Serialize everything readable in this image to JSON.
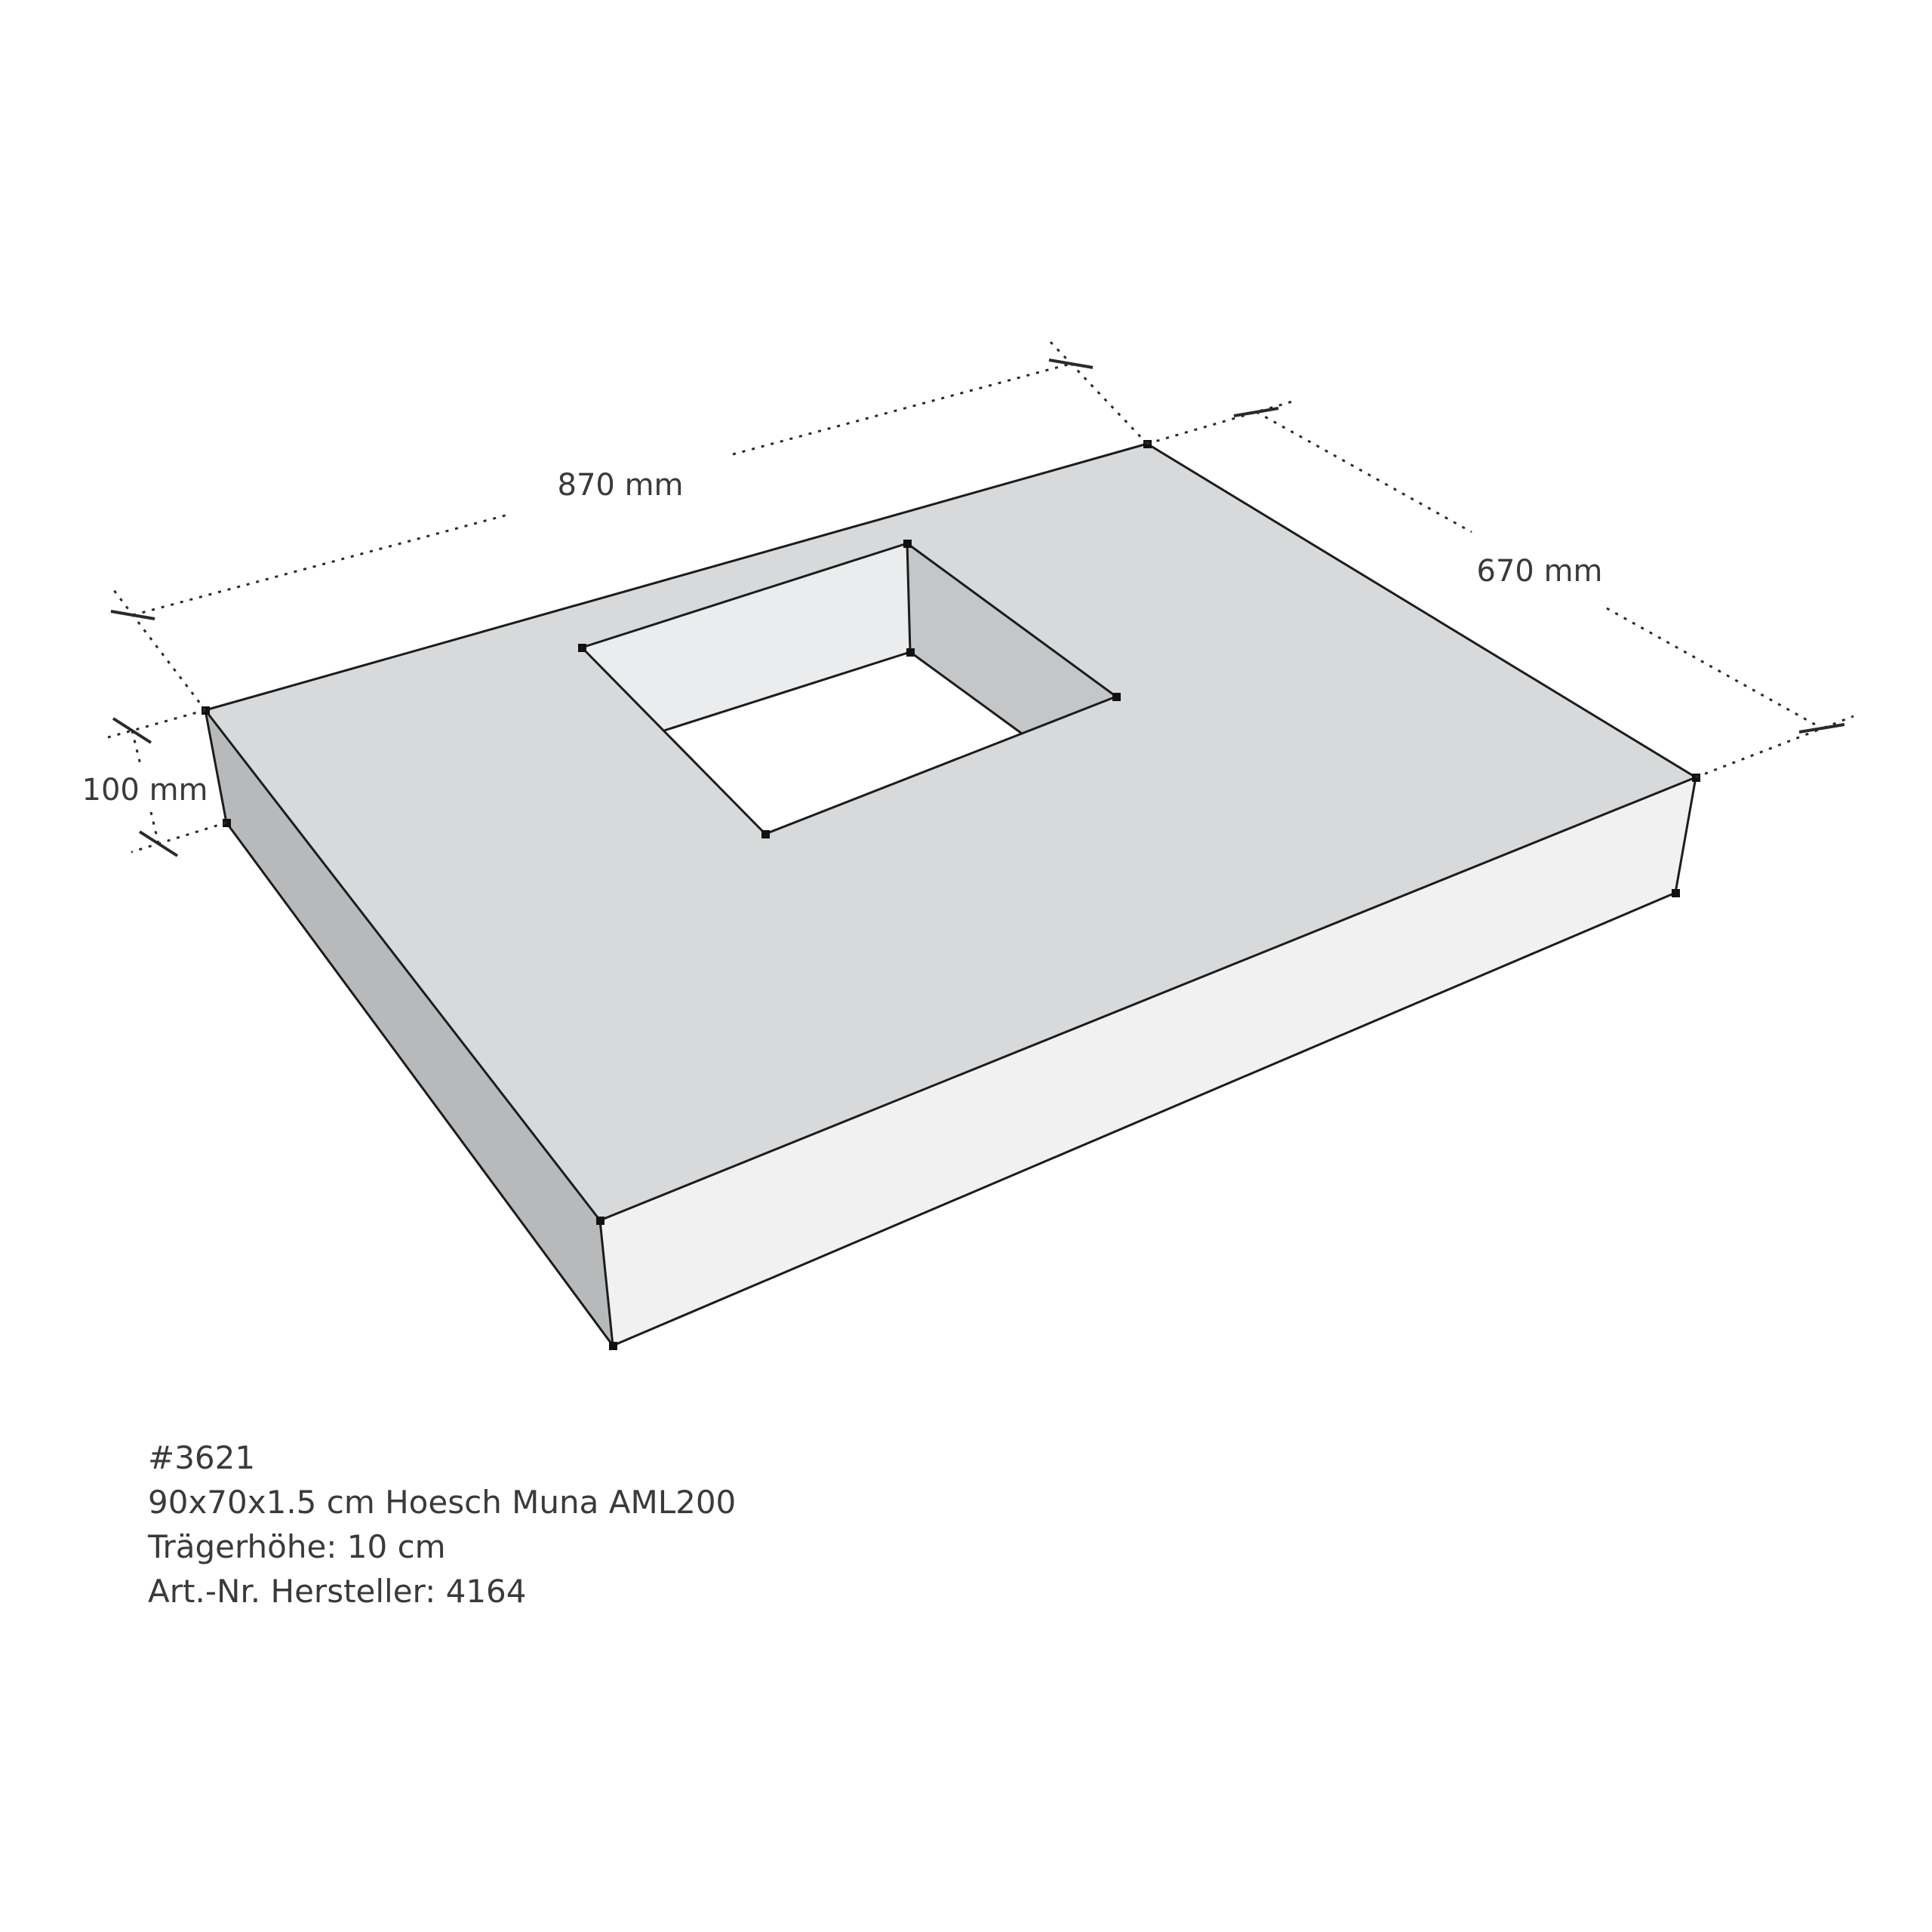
{
  "dimensions": {
    "width_label": "870 mm",
    "depth_label": "670 mm",
    "height_label": "100 mm"
  },
  "product_info": {
    "id": "#3621",
    "name": "90x70x1.5 cm Hoesch Muna AML200",
    "carrier_height": "Trägerhöhe: 10 cm",
    "article_number": "Art.-Nr. Hersteller: 4164"
  },
  "colors": {
    "background": "#ffffff",
    "top_face": "#d8d9da",
    "left_face": "#b7b9bb",
    "front_face": "#f1f1f2",
    "hole_left_wall": "#ebeced",
    "hole_right_wall": "#c4c6c8",
    "hole_floor": "#ffffff",
    "edge": "#1c1c1c",
    "dimension_line": "#2a2a2a",
    "vertex_dot": "#111111",
    "text": "#3a3a3a"
  }
}
